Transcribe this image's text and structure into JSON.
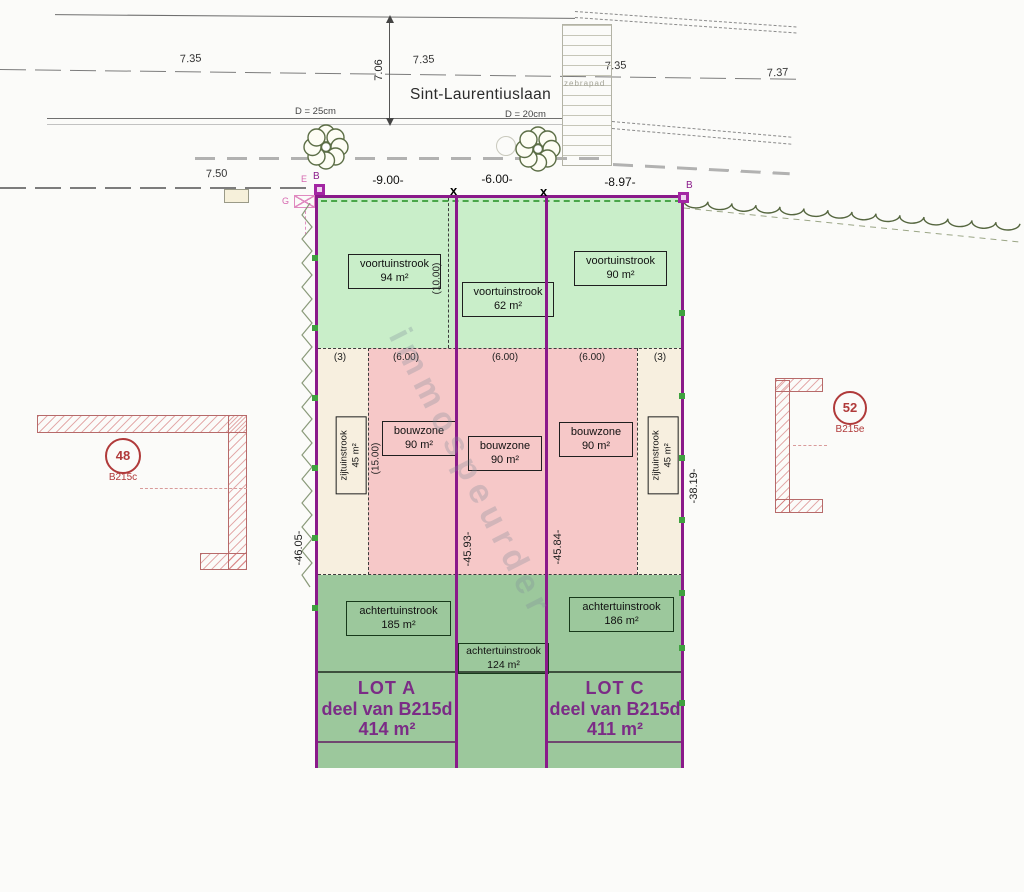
{
  "street": {
    "name": "Sint-Laurentiuslaan",
    "crossing_label": "zebrapad",
    "road_width_dim": "7.06",
    "elevation_left": "7.35",
    "elevation_mid": "7.35",
    "elevation_right": "7.35",
    "elevation_far_right": "7.37",
    "tree_left_diameter": "D = 25cm",
    "tree_right_diameter": "D = 20cm",
    "sidewalk_dim": "7.50"
  },
  "frontage": {
    "lot_a_width": "-9.00-",
    "lot_b_width": "-6.00-",
    "lot_c_width": "-8.97-",
    "marker_e": "E",
    "marker_b_left": "B",
    "marker_b_right": "B",
    "gas_marker": "G",
    "cross": "x"
  },
  "zone_dims": {
    "side_left": "(3)",
    "build_a": "(6.00)",
    "build_b": "(6.00)",
    "build_c": "(6.00)",
    "side_right": "(3)",
    "front_depth": "(10.00)",
    "build_depth": "(15.00)"
  },
  "depth_dims": {
    "left": "-46.05-",
    "between_a_b": "-45.93-",
    "between_b_c": "-45.84-",
    "right": "-38.19-"
  },
  "lot_a": {
    "front": {
      "name": "voortuinstrook",
      "area": "94 m²"
    },
    "side": {
      "name": "zijtuinstrook",
      "area": "45 m²"
    },
    "build": {
      "name": "bouwzone",
      "area": "90 m²"
    },
    "back": {
      "name": "achtertuinstrook",
      "area": "185 m²"
    },
    "title": "LOT A",
    "parcel": "deel van B215d",
    "area": "414 m²"
  },
  "lot_b": {
    "front": {
      "name": "voortuinstrook",
      "area": "62 m²"
    },
    "build": {
      "name": "bouwzone",
      "area": "90 m²"
    },
    "back": {
      "name": "achtertuinstrook",
      "area": "124 m²"
    }
  },
  "lot_c": {
    "front": {
      "name": "voortuinstrook",
      "area": "90 m²"
    },
    "side": {
      "name": "zijtuinstrook",
      "area": "45 m²"
    },
    "build": {
      "name": "bouwzone",
      "area": "90 m²"
    },
    "back": {
      "name": "achtertuinstrook",
      "area": "186 m²"
    },
    "title": "LOT C",
    "parcel": "deel van B215d",
    "area": "411 m²"
  },
  "neighbors": {
    "left": {
      "number": "48",
      "parcel": "B215c"
    },
    "right": {
      "number": "52",
      "parcel": "B215e"
    }
  },
  "watermark": "immospeurder",
  "colors": {
    "boundary_purple": "#8a1a8a",
    "front_garden_green": "#c9eec9",
    "back_garden_green": "#9cc89c",
    "build_zone_pink": "#f6c8c8",
    "side_strip_cream": "#f7efdf",
    "neighbor_red": "#b03a3a",
    "lot_text_purple": "#7b2c86",
    "hedge_green": "#3fa13f"
  }
}
